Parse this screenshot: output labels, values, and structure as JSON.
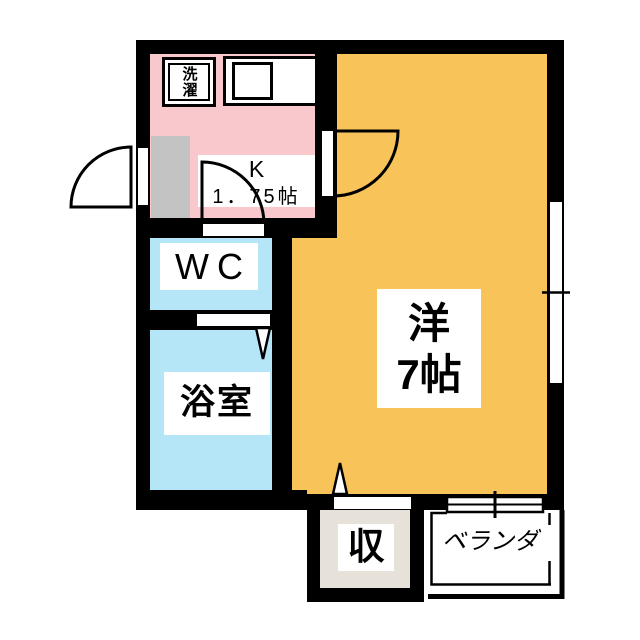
{
  "floorplan": {
    "kitchen": {
      "name": "K",
      "size": "1．75帖"
    },
    "laundry": {
      "label": "洗濯"
    },
    "wc": {
      "label": "WC"
    },
    "bath": {
      "label": "浴室"
    },
    "main_room": {
      "name": "洋",
      "size": "7帖"
    },
    "storage": {
      "label": "収"
    },
    "veranda": {
      "label": "ベランダ"
    },
    "colors": {
      "kitchen_floor": "#F9C8CD",
      "wc_bath_floor": "#B5E6F8",
      "main_room_floor": "#F8C359",
      "storage_floor": "#E6E2D9",
      "entry_floor": "#C3C3C3",
      "wall": "#000000",
      "label_background": "#FFFFFF",
      "text": "#000000"
    }
  }
}
